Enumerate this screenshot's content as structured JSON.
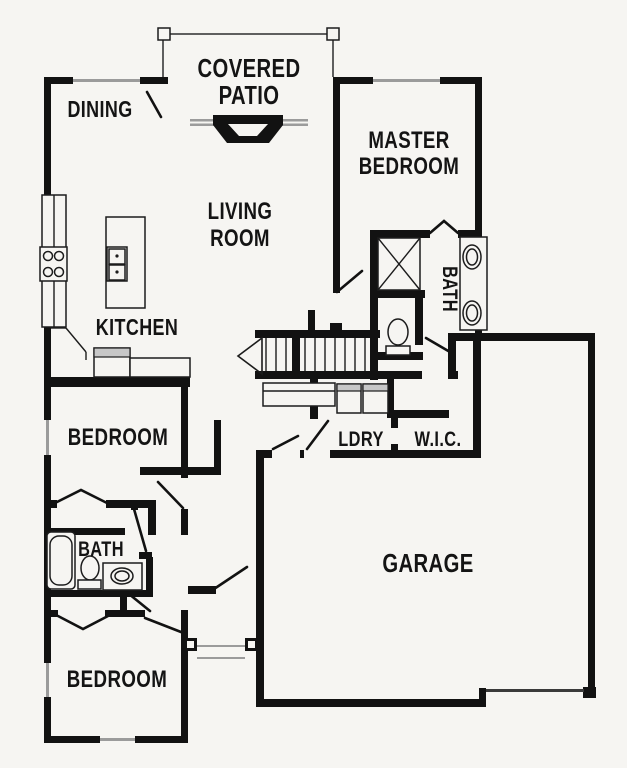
{
  "page": {
    "type": "residential-floor-plan",
    "description": "Black and white single-story house floor plan"
  },
  "colors": {
    "background": "#f6f5f2",
    "walls": "#121212",
    "windows": "#9b9b9b",
    "appliance_accent": "#c7c7c7"
  },
  "rooms": {
    "covered_patio": {
      "line1": "COVERED",
      "line2": "PATIO"
    },
    "dining": {
      "label": "DINING"
    },
    "master_bedroom": {
      "line1": "MASTER",
      "line2": "BEDROOM"
    },
    "living_room": {
      "line1": "LIVING",
      "line2": "ROOM"
    },
    "kitchen": {
      "label": "KITCHEN"
    },
    "master_bath": {
      "label": "BATH"
    },
    "laundry": {
      "label": "LDRY"
    },
    "walk_in_closet": {
      "label": "W.I.C."
    },
    "garage": {
      "label": "GARAGE"
    },
    "bedroom_front": {
      "label": "BEDROOM"
    },
    "hall_bath": {
      "label": "BATH"
    },
    "bedroom_corner": {
      "label": "BEDROOM"
    }
  },
  "fixtures": {
    "icons": [
      "fireplace-icon",
      "patio-post-icon",
      "sliding-glass-door-icon",
      "range-stove-icon",
      "island-sink-icon",
      "dishwasher-icon",
      "counter-icon",
      "staircase-icon",
      "stair-direction-arrow-icon",
      "washer-icon",
      "dryer-icon",
      "shower-icon",
      "toilet-icon",
      "double-vanity-sink-icon",
      "bathtub-icon",
      "vanity-sink-icon",
      "porch-post-icon",
      "garage-door-icon",
      "window-icon",
      "door-swing-icon"
    ]
  }
}
